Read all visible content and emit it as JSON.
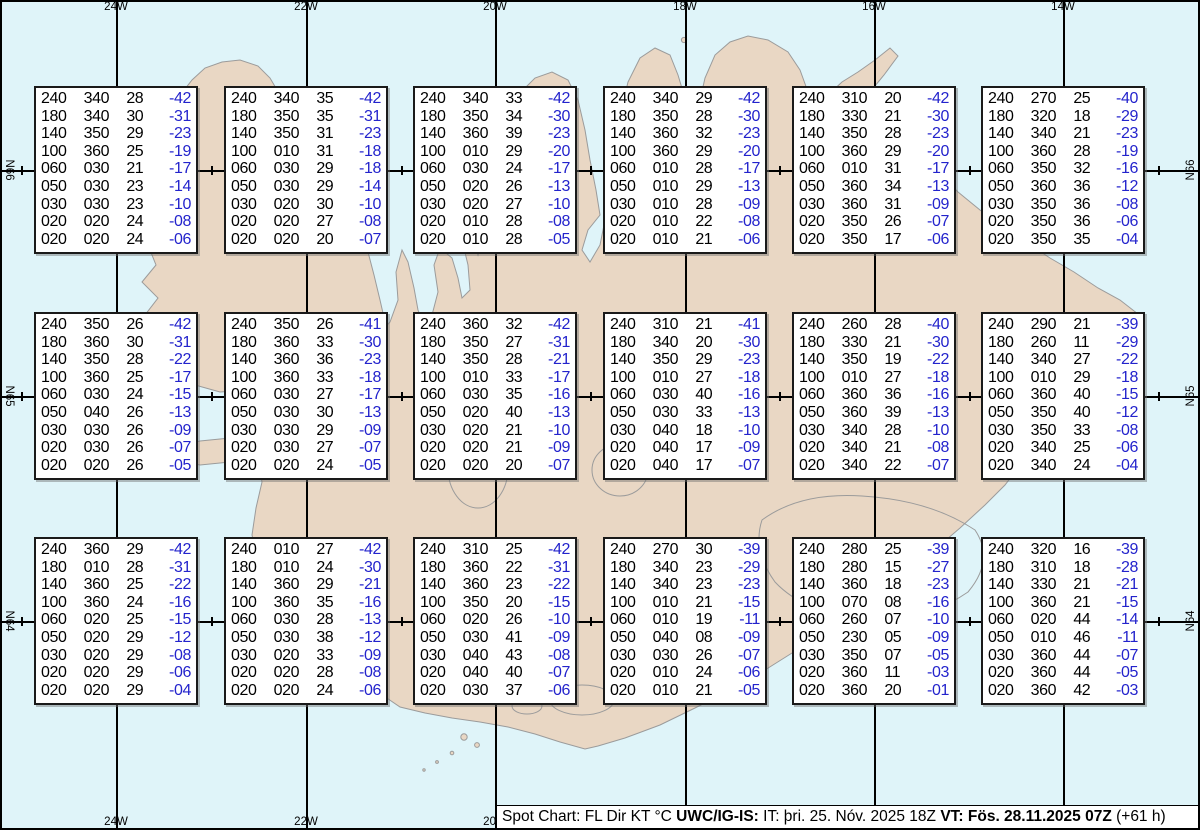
{
  "legend": {
    "columns": [
      "FL",
      "Dir",
      "KT",
      "°C"
    ]
  },
  "colors": {
    "sea": "#dff4f9",
    "land": "#e9d7c4",
    "coastline": "#9b9b9b",
    "grid_line": "#000000",
    "box_background": "#ffffff",
    "value_text": "#000000",
    "temperature_text": "#2323cc",
    "frame": "#000000",
    "label_text": "#000000",
    "bar_background": "#ffffff"
  },
  "graticule": {
    "meridians": [
      {
        "label": "24W",
        "x": 116,
        "top_label": true,
        "bottom_label": true
      },
      {
        "label": "22W",
        "x": 306,
        "top_label": true,
        "bottom_label": true
      },
      {
        "label": "20W",
        "x": 495,
        "top_label": true,
        "bottom_label": true
      },
      {
        "label": "18W",
        "x": 685,
        "top_label": true,
        "bottom_label": false
      },
      {
        "label": "16W",
        "x": 874,
        "top_label": true,
        "bottom_label": false
      },
      {
        "label": "14W",
        "x": 1063,
        "top_label": true,
        "bottom_label": false
      }
    ],
    "parallels": [
      {
        "label": "N66",
        "y": 170
      },
      {
        "label": "N65",
        "y": 396
      },
      {
        "label": "N64",
        "y": 621
      }
    ],
    "tick_xs": [
      21,
      211,
      401,
      590,
      779,
      969,
      1158
    ]
  },
  "boxes": [
    {
      "lines": [
        [
          "240",
          "340",
          "28",
          "-42"
        ],
        [
          "180",
          "340",
          "30",
          "-31"
        ],
        [
          "140",
          "350",
          "29",
          "-23"
        ],
        [
          "100",
          "360",
          "25",
          "-19"
        ],
        [
          "060",
          "030",
          "21",
          "-17"
        ],
        [
          "050",
          "030",
          "23",
          "-14"
        ],
        [
          "030",
          "030",
          "23",
          "-10"
        ],
        [
          "020",
          "020",
          "24",
          "-08"
        ],
        [
          "020",
          "020",
          "24",
          "-06"
        ]
      ]
    },
    {
      "lines": [
        [
          "240",
          "340",
          "35",
          "-42"
        ],
        [
          "180",
          "350",
          "35",
          "-31"
        ],
        [
          "140",
          "350",
          "31",
          "-23"
        ],
        [
          "100",
          "010",
          "31",
          "-18"
        ],
        [
          "060",
          "030",
          "29",
          "-18"
        ],
        [
          "050",
          "030",
          "29",
          "-14"
        ],
        [
          "030",
          "020",
          "30",
          "-10"
        ],
        [
          "020",
          "020",
          "27",
          "-08"
        ],
        [
          "020",
          "020",
          "20",
          "-07"
        ]
      ]
    },
    {
      "lines": [
        [
          "240",
          "340",
          "33",
          "-42"
        ],
        [
          "180",
          "350",
          "34",
          "-30"
        ],
        [
          "140",
          "360",
          "39",
          "-23"
        ],
        [
          "100",
          "010",
          "29",
          "-20"
        ],
        [
          "060",
          "030",
          "24",
          "-17"
        ],
        [
          "050",
          "020",
          "26",
          "-13"
        ],
        [
          "030",
          "020",
          "27",
          "-10"
        ],
        [
          "020",
          "010",
          "28",
          "-08"
        ],
        [
          "020",
          "010",
          "28",
          "-05"
        ]
      ]
    },
    {
      "lines": [
        [
          "240",
          "340",
          "29",
          "-42"
        ],
        [
          "180",
          "350",
          "28",
          "-30"
        ],
        [
          "140",
          "360",
          "32",
          "-23"
        ],
        [
          "100",
          "360",
          "29",
          "-20"
        ],
        [
          "060",
          "010",
          "28",
          "-17"
        ],
        [
          "050",
          "010",
          "29",
          "-13"
        ],
        [
          "030",
          "010",
          "28",
          "-09"
        ],
        [
          "020",
          "010",
          "22",
          "-08"
        ],
        [
          "020",
          "010",
          "21",
          "-06"
        ]
      ]
    },
    {
      "lines": [
        [
          "240",
          "310",
          "20",
          "-42"
        ],
        [
          "180",
          "330",
          "21",
          "-30"
        ],
        [
          "140",
          "350",
          "28",
          "-23"
        ],
        [
          "100",
          "360",
          "29",
          "-20"
        ],
        [
          "060",
          "010",
          "31",
          "-17"
        ],
        [
          "050",
          "360",
          "34",
          "-13"
        ],
        [
          "030",
          "360",
          "31",
          "-09"
        ],
        [
          "020",
          "350",
          "26",
          "-07"
        ],
        [
          "020",
          "350",
          "17",
          "-06"
        ]
      ]
    },
    {
      "lines": [
        [
          "240",
          "270",
          "25",
          "-40"
        ],
        [
          "180",
          "320",
          "18",
          "-29"
        ],
        [
          "140",
          "340",
          "21",
          "-23"
        ],
        [
          "100",
          "360",
          "28",
          "-19"
        ],
        [
          "060",
          "350",
          "32",
          "-16"
        ],
        [
          "050",
          "360",
          "36",
          "-12"
        ],
        [
          "030",
          "350",
          "36",
          "-08"
        ],
        [
          "020",
          "350",
          "36",
          "-06"
        ],
        [
          "020",
          "350",
          "35",
          "-04"
        ]
      ]
    },
    {
      "lines": [
        [
          "240",
          "350",
          "26",
          "-42"
        ],
        [
          "180",
          "360",
          "30",
          "-31"
        ],
        [
          "140",
          "350",
          "28",
          "-22"
        ],
        [
          "100",
          "360",
          "25",
          "-17"
        ],
        [
          "060",
          "030",
          "24",
          "-15"
        ],
        [
          "050",
          "040",
          "26",
          "-13"
        ],
        [
          "030",
          "030",
          "26",
          "-09"
        ],
        [
          "020",
          "030",
          "26",
          "-07"
        ],
        [
          "020",
          "020",
          "26",
          "-05"
        ]
      ]
    },
    {
      "lines": [
        [
          "240",
          "350",
          "26",
          "-41"
        ],
        [
          "180",
          "360",
          "33",
          "-30"
        ],
        [
          "140",
          "360",
          "36",
          "-23"
        ],
        [
          "100",
          "360",
          "33",
          "-18"
        ],
        [
          "060",
          "030",
          "27",
          "-17"
        ],
        [
          "050",
          "030",
          "30",
          "-13"
        ],
        [
          "030",
          "030",
          "29",
          "-09"
        ],
        [
          "020",
          "030",
          "27",
          "-07"
        ],
        [
          "020",
          "020",
          "24",
          "-05"
        ]
      ]
    },
    {
      "lines": [
        [
          "240",
          "360",
          "32",
          "-42"
        ],
        [
          "180",
          "350",
          "27",
          "-31"
        ],
        [
          "140",
          "350",
          "28",
          "-21"
        ],
        [
          "100",
          "010",
          "33",
          "-17"
        ],
        [
          "060",
          "030",
          "35",
          "-16"
        ],
        [
          "050",
          "020",
          "40",
          "-13"
        ],
        [
          "030",
          "020",
          "21",
          "-10"
        ],
        [
          "020",
          "020",
          "21",
          "-09"
        ],
        [
          "020",
          "020",
          "20",
          "-07"
        ]
      ]
    },
    {
      "lines": [
        [
          "240",
          "310",
          "21",
          "-41"
        ],
        [
          "180",
          "340",
          "20",
          "-30"
        ],
        [
          "140",
          "350",
          "29",
          "-23"
        ],
        [
          "100",
          "010",
          "27",
          "-18"
        ],
        [
          "060",
          "030",
          "40",
          "-16"
        ],
        [
          "050",
          "030",
          "33",
          "-13"
        ],
        [
          "030",
          "040",
          "18",
          "-10"
        ],
        [
          "020",
          "040",
          "17",
          "-09"
        ],
        [
          "020",
          "040",
          "17",
          "-07"
        ]
      ]
    },
    {
      "lines": [
        [
          "240",
          "260",
          "28",
          "-40"
        ],
        [
          "180",
          "330",
          "21",
          "-30"
        ],
        [
          "140",
          "350",
          "19",
          "-22"
        ],
        [
          "100",
          "010",
          "27",
          "-18"
        ],
        [
          "060",
          "360",
          "36",
          "-16"
        ],
        [
          "050",
          "360",
          "39",
          "-13"
        ],
        [
          "030",
          "340",
          "28",
          "-10"
        ],
        [
          "020",
          "340",
          "21",
          "-08"
        ],
        [
          "020",
          "340",
          "22",
          "-07"
        ]
      ]
    },
    {
      "lines": [
        [
          "240",
          "290",
          "21",
          "-39"
        ],
        [
          "180",
          "260",
          "11",
          "-29"
        ],
        [
          "140",
          "340",
          "27",
          "-22"
        ],
        [
          "100",
          "010",
          "29",
          "-18"
        ],
        [
          "060",
          "360",
          "40",
          "-15"
        ],
        [
          "050",
          "350",
          "40",
          "-12"
        ],
        [
          "030",
          "350",
          "33",
          "-08"
        ],
        [
          "020",
          "340",
          "25",
          "-06"
        ],
        [
          "020",
          "340",
          "24",
          "-04"
        ]
      ]
    },
    {
      "lines": [
        [
          "240",
          "360",
          "29",
          "-42"
        ],
        [
          "180",
          "010",
          "28",
          "-31"
        ],
        [
          "140",
          "360",
          "25",
          "-22"
        ],
        [
          "100",
          "360",
          "24",
          "-16"
        ],
        [
          "060",
          "020",
          "25",
          "-15"
        ],
        [
          "050",
          "020",
          "29",
          "-12"
        ],
        [
          "030",
          "020",
          "29",
          "-08"
        ],
        [
          "020",
          "020",
          "29",
          "-06"
        ],
        [
          "020",
          "020",
          "29",
          "-04"
        ]
      ]
    },
    {
      "lines": [
        [
          "240",
          "010",
          "27",
          "-42"
        ],
        [
          "180",
          "010",
          "24",
          "-30"
        ],
        [
          "140",
          "360",
          "29",
          "-21"
        ],
        [
          "100",
          "360",
          "35",
          "-16"
        ],
        [
          "060",
          "030",
          "28",
          "-13"
        ],
        [
          "050",
          "030",
          "38",
          "-12"
        ],
        [
          "030",
          "020",
          "33",
          "-09"
        ],
        [
          "020",
          "020",
          "28",
          "-08"
        ],
        [
          "020",
          "020",
          "24",
          "-06"
        ]
      ]
    },
    {
      "lines": [
        [
          "240",
          "310",
          "25",
          "-42"
        ],
        [
          "180",
          "360",
          "22",
          "-31"
        ],
        [
          "140",
          "360",
          "23",
          "-22"
        ],
        [
          "100",
          "350",
          "20",
          "-15"
        ],
        [
          "060",
          "020",
          "26",
          "-10"
        ],
        [
          "050",
          "030",
          "41",
          "-09"
        ],
        [
          "030",
          "040",
          "43",
          "-08"
        ],
        [
          "020",
          "040",
          "40",
          "-07"
        ],
        [
          "020",
          "030",
          "37",
          "-06"
        ]
      ]
    },
    {
      "lines": [
        [
          "240",
          "270",
          "30",
          "-39"
        ],
        [
          "180",
          "340",
          "23",
          "-29"
        ],
        [
          "140",
          "340",
          "23",
          "-23"
        ],
        [
          "100",
          "010",
          "21",
          "-15"
        ],
        [
          "060",
          "010",
          "19",
          "-11"
        ],
        [
          "050",
          "040",
          "08",
          "-09"
        ],
        [
          "030",
          "030",
          "26",
          "-07"
        ],
        [
          "020",
          "010",
          "24",
          "-06"
        ],
        [
          "020",
          "010",
          "21",
          "-05"
        ]
      ]
    },
    {
      "lines": [
        [
          "240",
          "280",
          "25",
          "-39"
        ],
        [
          "180",
          "280",
          "15",
          "-27"
        ],
        [
          "140",
          "360",
          "18",
          "-23"
        ],
        [
          "100",
          "070",
          "08",
          "-16"
        ],
        [
          "060",
          "260",
          "07",
          "-10"
        ],
        [
          "050",
          "230",
          "05",
          "-09"
        ],
        [
          "030",
          "350",
          "07",
          "-05"
        ],
        [
          "020",
          "360",
          "11",
          "-03"
        ],
        [
          "020",
          "360",
          "20",
          "-01"
        ]
      ]
    },
    {
      "lines": [
        [
          "240",
          "320",
          "16",
          "-39"
        ],
        [
          "180",
          "310",
          "18",
          "-28"
        ],
        [
          "140",
          "330",
          "21",
          "-21"
        ],
        [
          "100",
          "360",
          "21",
          "-15"
        ],
        [
          "060",
          "020",
          "44",
          "-14"
        ],
        [
          "050",
          "010",
          "46",
          "-11"
        ],
        [
          "030",
          "360",
          "44",
          "-07"
        ],
        [
          "020",
          "360",
          "44",
          "-05"
        ],
        [
          "020",
          "360",
          "42",
          "-03"
        ]
      ]
    }
  ],
  "statusbar": {
    "segments": [
      {
        "text": "Spot Chart: FL Dir KT °C ",
        "bold": false
      },
      {
        "text": "UWC/IG-IS:",
        "bold": true
      },
      {
        "text": " IT: þri. 25. Nóv. 2025 18Z ",
        "bold": false
      },
      {
        "text": "VT: Fös. 28.11.2025 07Z",
        "bold": true
      },
      {
        "text": " (+61 h)",
        "bold": false
      }
    ]
  }
}
